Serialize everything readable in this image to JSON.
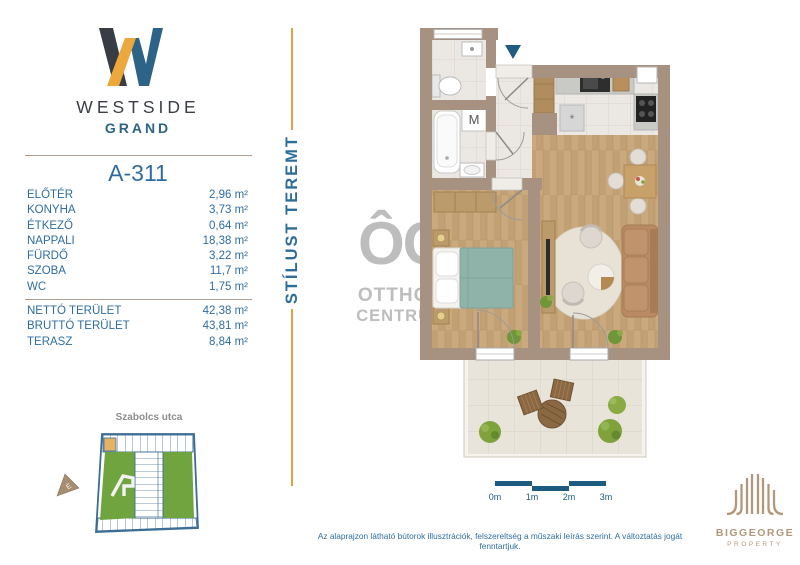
{
  "branding": {
    "logo_title": "WESTSIDE",
    "logo_subtitle": "GRAND",
    "tagline_vertical": "STÍLUST TEREMT"
  },
  "unit": {
    "id": "A-311",
    "rooms": [
      {
        "name": "ELŐTÉR",
        "area": "2,96 m²"
      },
      {
        "name": "KONYHA",
        "area": "3,73 m²"
      },
      {
        "name": "ÉTKEZŐ",
        "area": "0,64 m²"
      },
      {
        "name": "NAPPALI",
        "area": "18,38 m²"
      },
      {
        "name": "FÜRDŐ",
        "area": "3,22 m²"
      },
      {
        "name": "SZOBA",
        "area": "11,7 m²"
      },
      {
        "name": "WC",
        "area": "1,75 m²"
      }
    ],
    "totals": [
      {
        "name": "NETTÓ TERÜLET",
        "area": "42,38 m²"
      },
      {
        "name": "BRUTTÓ TERÜLET",
        "area": "43,81 m²"
      },
      {
        "name": "TERASZ",
        "area": "8,84 m²"
      }
    ]
  },
  "site_map": {
    "street_label": "Szabolcs utca",
    "compass_label": "É"
  },
  "floor_plan": {
    "washing_machine_label": "M",
    "fridge_mark": "*"
  },
  "watermark": {
    "monogram": "ÔC",
    "line1": "OTTHON",
    "line2": "CENTRUM"
  },
  "scale_bar": {
    "labels": [
      "0m",
      "1m",
      "2m",
      "3m"
    ]
  },
  "developer": {
    "name": "BIGGEORGE",
    "division": "PROPERTY"
  },
  "footer": {
    "disclaimer": "Az alaprajzon látható bútorok illusztrációk, felszereltség a műszaki leírás szerint. A változtatás jogát fenntartjuk."
  },
  "colors": {
    "brand_blue": "#2e6da0",
    "brand_steel": "#2c6386",
    "brand_dark": "#3a3f46",
    "brand_gold": "#eca83d",
    "divider_tan": "#b19f8b",
    "wall": "#a79181",
    "wood_floor": "#c9a97d",
    "courtyard_green": "#6fa43e",
    "developer_tan": "#b2977a",
    "scale_blue": "#1d5c80",
    "watermark_gray": "#bdbdbd"
  }
}
